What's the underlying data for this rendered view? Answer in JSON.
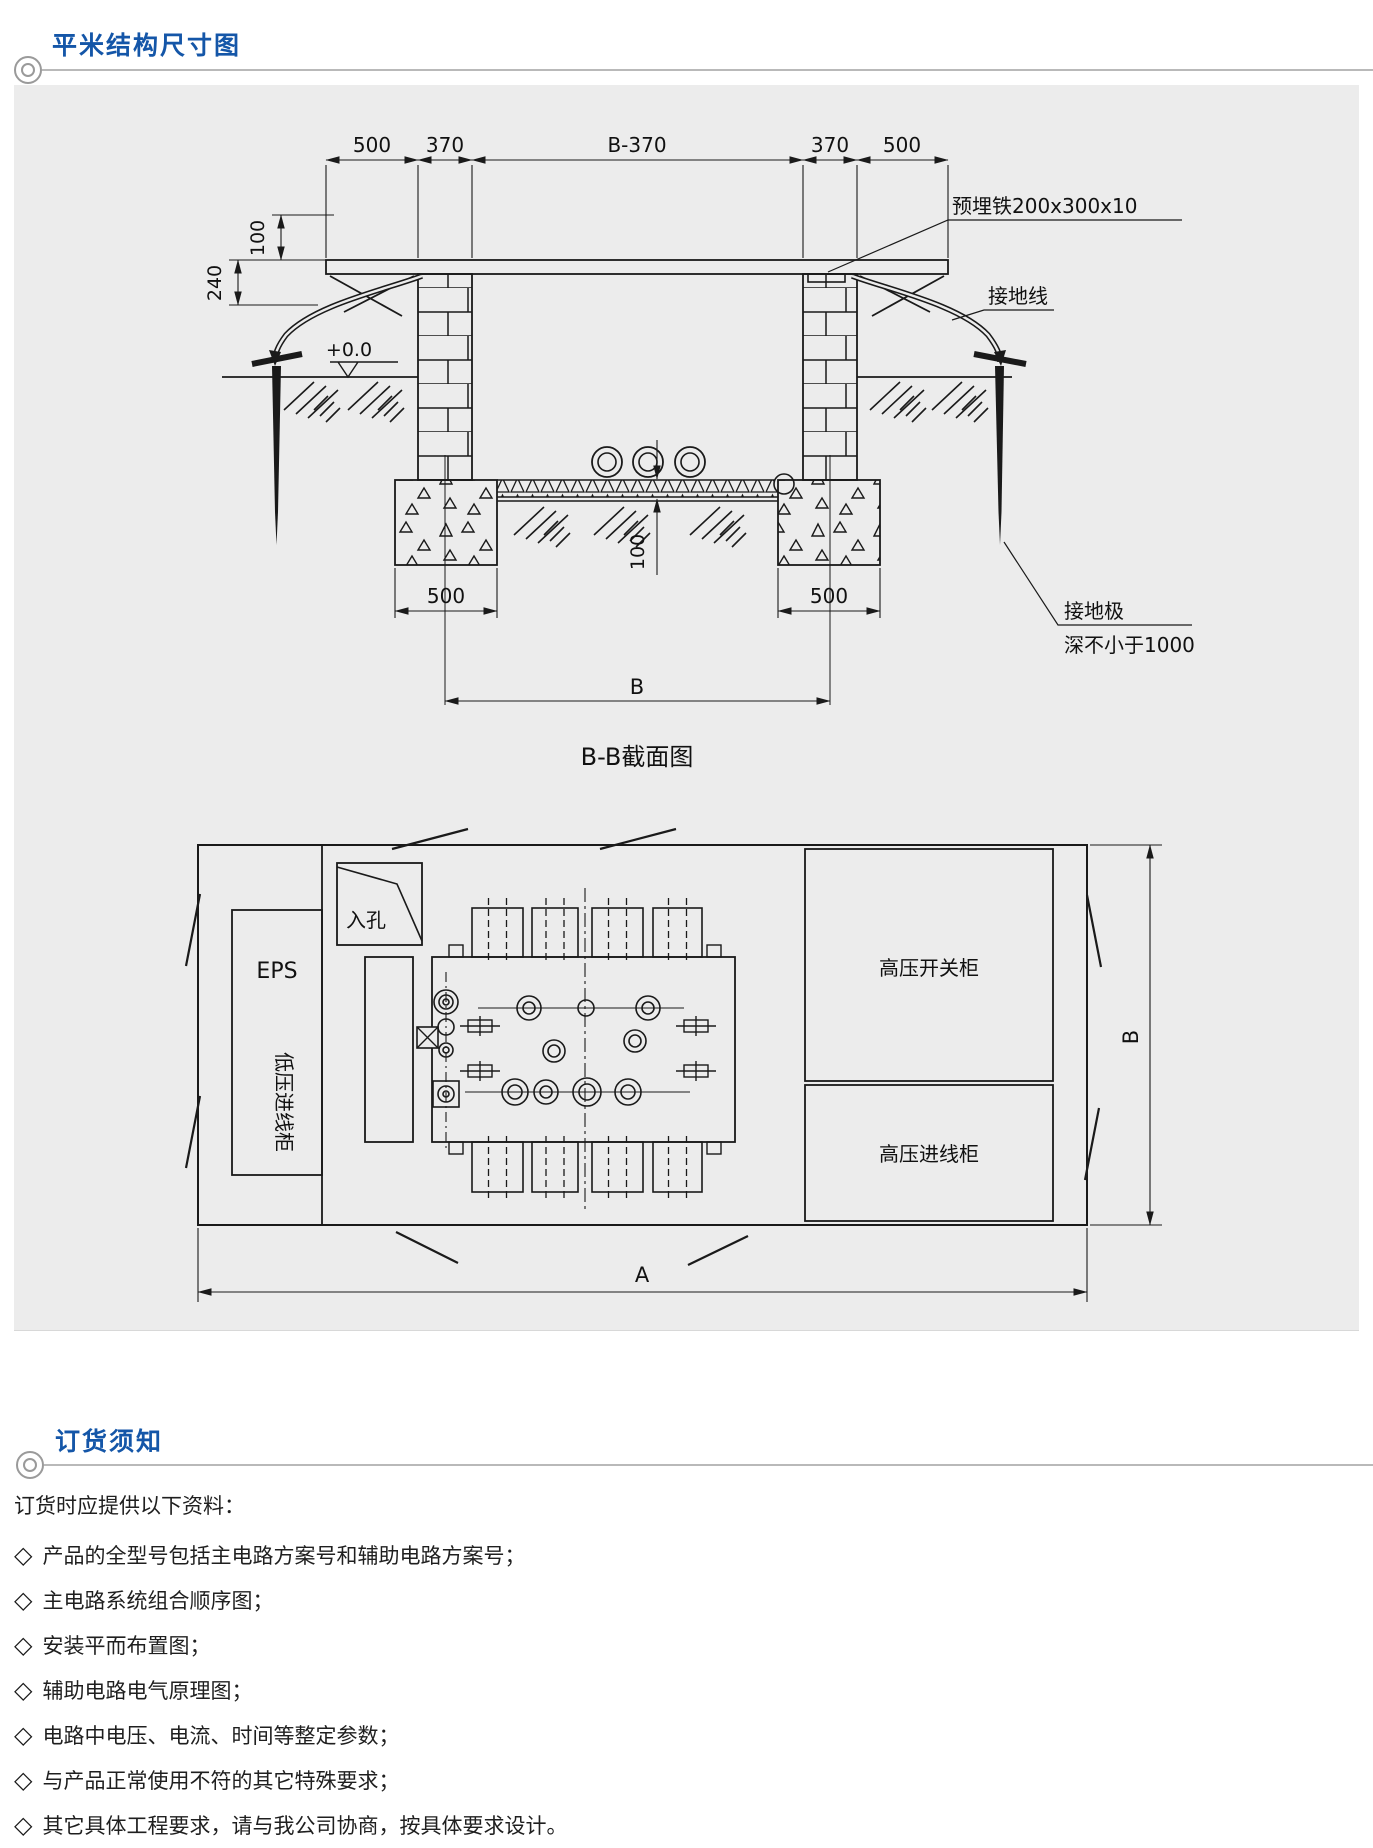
{
  "header1": {
    "title": "平米结构尺寸图"
  },
  "header2": {
    "title": "订货须知"
  },
  "cross_section": {
    "caption": "B-B截面图",
    "dim_top_left_overhang": "500",
    "dim_top_left_wall": "370",
    "dim_top_span": "B-370",
    "dim_top_right_wall": "370",
    "dim_top_right_overhang": "500",
    "dim_height_upper": "100",
    "dim_height_lower": "240",
    "level_mark": "+0.0",
    "dim_footing_left": "500",
    "dim_footing_right": "500",
    "dim_span": "B",
    "dim_floor_thickness": "100",
    "label_embedded_plate": "预埋铁200x300x10",
    "label_ground_wire": "接地线",
    "label_ground_rod": "接地极",
    "label_ground_rod_depth": "深不小于1000"
  },
  "plan_view": {
    "label_manhole": "入孔",
    "label_eps": "EPS",
    "label_lv_incoming": "低压进线柜",
    "label_hv_switchgear": "高压开关柜",
    "label_hv_incoming": "高压进线柜",
    "dim_width": "A",
    "dim_depth": "B"
  },
  "order_notes": {
    "intro": "订货时应提供以下资料：",
    "bullet": "◇",
    "items": [
      "产品的全型号包括主电路方案号和辅助电路方案号；",
      "主电路系统组合顺序图；",
      "安装平而布置图；",
      "辅助电路电气原理图；",
      "电路中电压、电流、时间等整定参数；",
      "与产品正常使用不符的其它特殊要求；",
      "其它具体工程要求，请与我公司协商，按具体要求设计。"
    ]
  }
}
